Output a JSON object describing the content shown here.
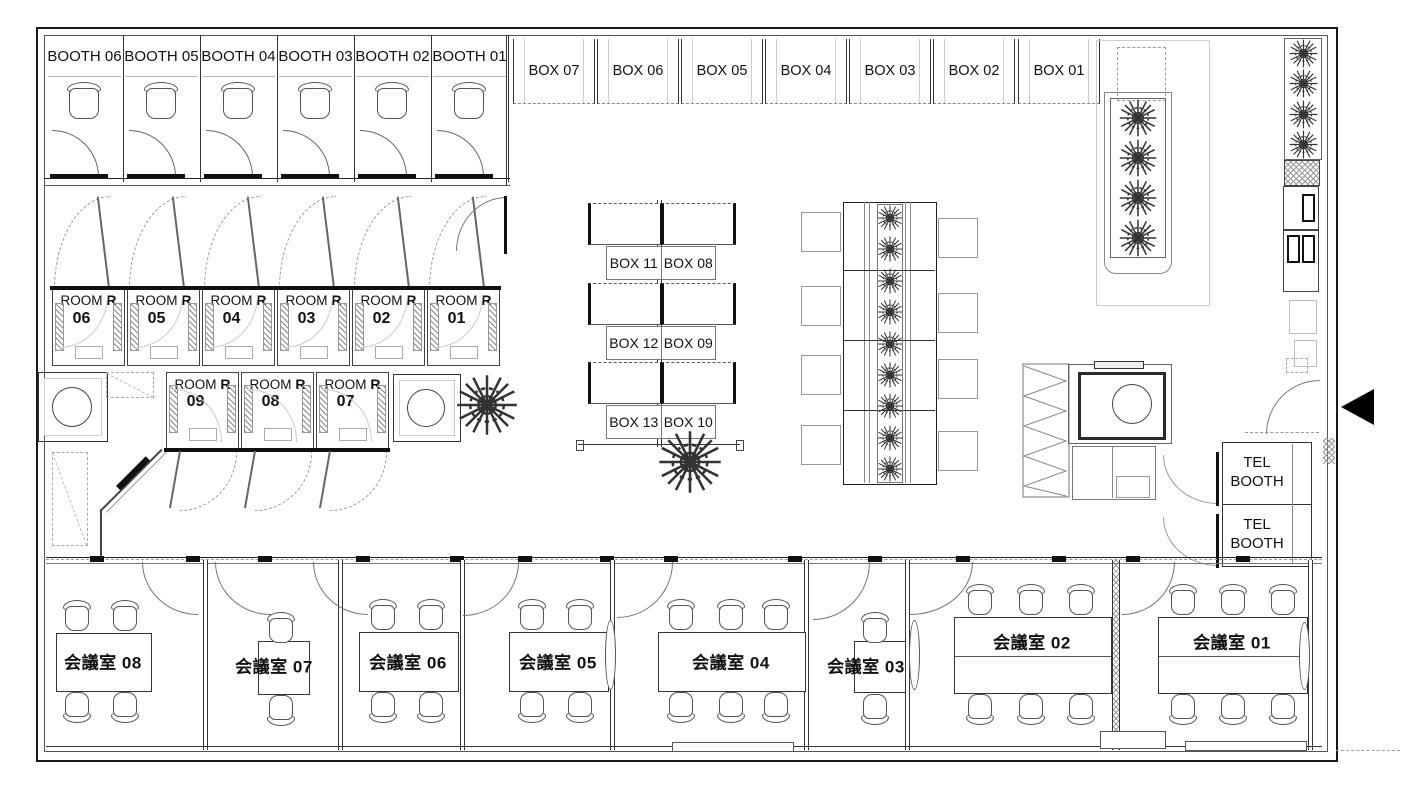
{
  "booths": [
    {
      "label": "BOOTH 06"
    },
    {
      "label": "BOOTH 05"
    },
    {
      "label": "BOOTH 04"
    },
    {
      "label": "BOOTH 03"
    },
    {
      "label": "BOOTH 02"
    },
    {
      "label": "BOOTH 01"
    }
  ],
  "wall_boxes": [
    {
      "label": "BOX 07"
    },
    {
      "label": "BOX 06"
    },
    {
      "label": "BOX 05"
    },
    {
      "label": "BOX 04"
    },
    {
      "label": "BOX 03"
    },
    {
      "label": "BOX 02"
    },
    {
      "label": "BOX 01"
    }
  ],
  "rooms_top": [
    {
      "name": "ROOM",
      "type": "R",
      "number": "06"
    },
    {
      "name": "ROOM",
      "type": "R",
      "number": "05"
    },
    {
      "name": "ROOM",
      "type": "R",
      "number": "04"
    },
    {
      "name": "ROOM",
      "type": "R",
      "number": "03"
    },
    {
      "name": "ROOM",
      "type": "R",
      "number": "02"
    },
    {
      "name": "ROOM",
      "type": "R",
      "number": "01"
    }
  ],
  "rooms_mid": [
    {
      "name": "ROOM",
      "type": "R",
      "number": "09"
    },
    {
      "name": "ROOM",
      "type": "R",
      "number": "08"
    },
    {
      "name": "ROOM",
      "type": "R",
      "number": "07"
    }
  ],
  "storage_units": [
    {
      "left": "BOX 11",
      "right": "BOX 08"
    },
    {
      "left": "BOX 12",
      "right": "BOX 09"
    },
    {
      "left": "BOX 13",
      "right": "BOX 10"
    }
  ],
  "tel_booths": [
    {
      "label": "TEL BOOTH"
    },
    {
      "label": "TEL BOOTH"
    }
  ],
  "meeting_rooms": [
    {
      "label": "会議室 08"
    },
    {
      "label": "会議室 07"
    },
    {
      "label": "会議室 06"
    },
    {
      "label": "会議室 05"
    },
    {
      "label": "会議室 04"
    },
    {
      "label": "会議室 03"
    },
    {
      "label": "会議室 02"
    },
    {
      "label": "会議室 01"
    }
  ]
}
